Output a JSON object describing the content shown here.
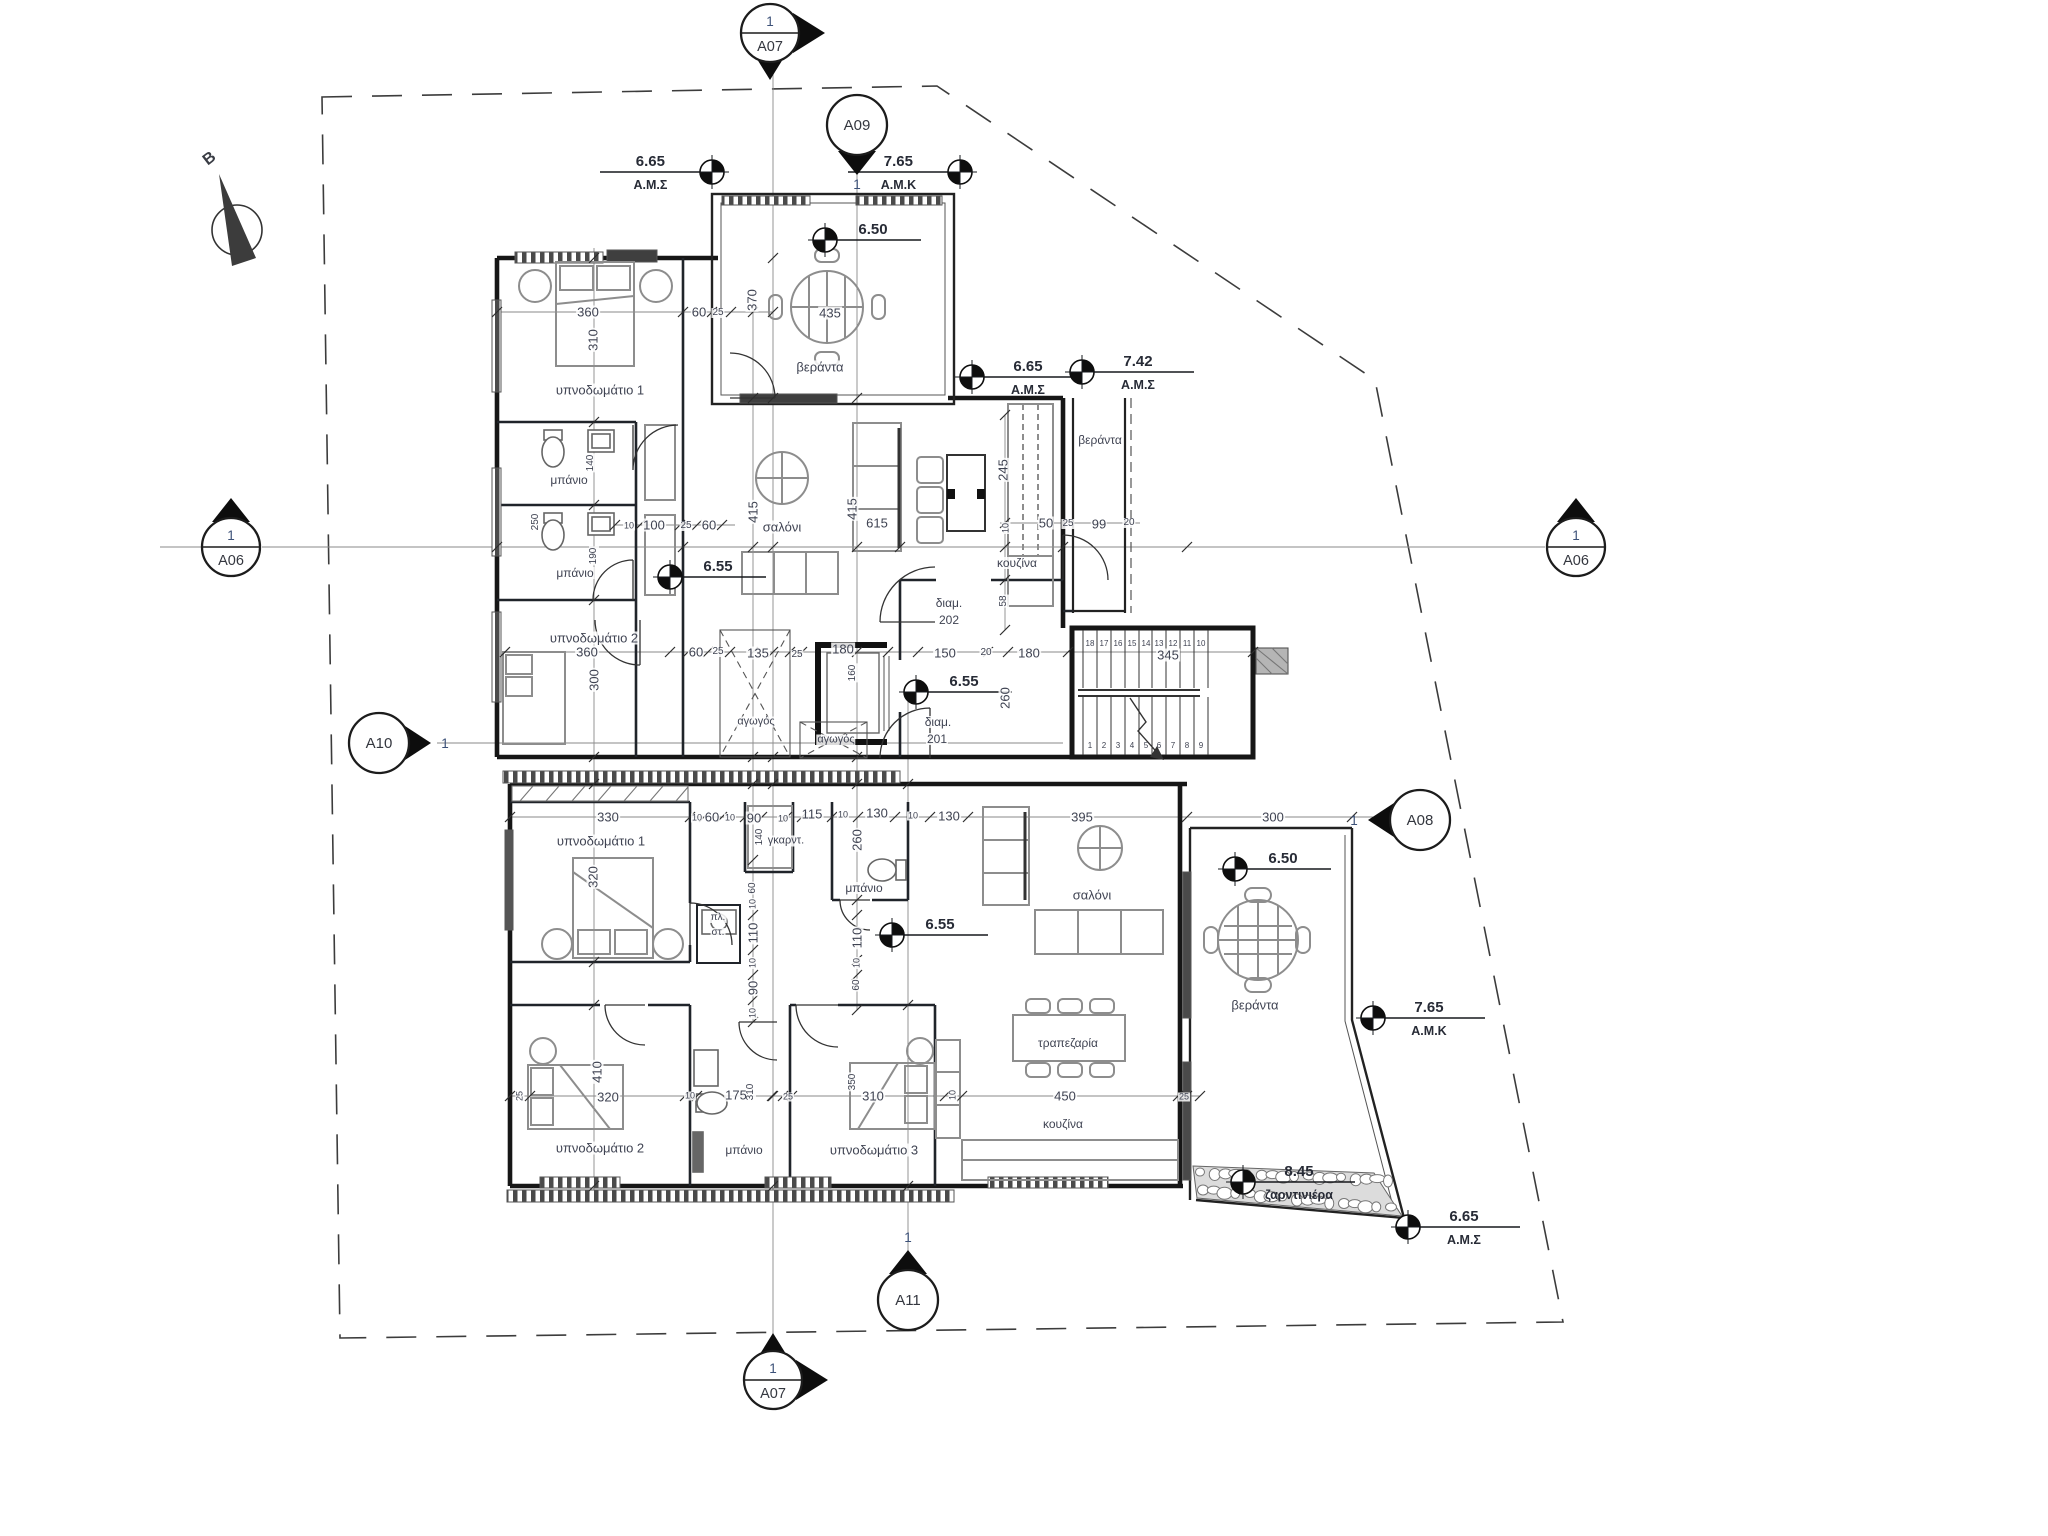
{
  "colors": {
    "wall": "#161616",
    "text": "#3f4352",
    "marker_number_blue": "#3c5178",
    "level_text": "#272b36",
    "boundary": "#3c3c3c"
  },
  "plan": {
    "north_label": "B",
    "sections": [
      {
        "name": "section-marker-a07-top",
        "id": "A07",
        "num": "1",
        "x": 770,
        "y": 33,
        "style": "split",
        "pointer": "right-down"
      },
      {
        "name": "section-marker-a09",
        "id": "A09",
        "num": "1",
        "x": 857,
        "y": 125,
        "style": "plain",
        "pointer": "down"
      },
      {
        "name": "section-marker-a06-left",
        "id": "A06",
        "num": "1",
        "x": 231,
        "y": 547,
        "style": "split",
        "pointer": "up"
      },
      {
        "name": "section-marker-a06-right",
        "id": "A06",
        "num": "1",
        "x": 1576,
        "y": 547,
        "style": "split",
        "pointer": "up"
      },
      {
        "name": "section-marker-a10",
        "id": "A10",
        "num": "1",
        "x": 379,
        "y": 743,
        "style": "plain",
        "pointer": "right"
      },
      {
        "name": "section-marker-a08",
        "id": "A08",
        "num": "1",
        "x": 1420,
        "y": 820,
        "style": "plain",
        "pointer": "left"
      },
      {
        "name": "section-marker-a11",
        "id": "A11",
        "num": "1",
        "x": 908,
        "y": 1300,
        "style": "plain",
        "pointer": "up"
      },
      {
        "name": "section-marker-a07-bottom",
        "id": "A07",
        "num": "1",
        "x": 773,
        "y": 1380,
        "style": "split",
        "pointer": "right-up"
      }
    ],
    "levels": [
      {
        "name": "level-665-top",
        "value": "6.65",
        "sub": "Α.Μ.Σ",
        "x": 712,
        "y": 172,
        "dir": "left"
      },
      {
        "name": "level-765-top",
        "value": "7.65",
        "sub": "Α.Μ.Κ",
        "x": 960,
        "y": 172,
        "dir": "left"
      },
      {
        "name": "level-650-top-veranda",
        "value": "6.50",
        "sub": "",
        "x": 825,
        "y": 240,
        "dir": "right"
      },
      {
        "name": "level-665-mid",
        "value": "6.65",
        "sub": "Α.Μ.Σ",
        "x": 972,
        "y": 377,
        "dir": "right"
      },
      {
        "name": "level-742",
        "value": "7.42",
        "sub": "Α.Μ.Σ",
        "x": 1082,
        "y": 372,
        "dir": "right"
      },
      {
        "name": "level-655-bath",
        "value": "6.55",
        "sub": "",
        "x": 670,
        "y": 577,
        "dir": "right"
      },
      {
        "name": "level-655-hall",
        "value": "6.55",
        "sub": "",
        "x": 916,
        "y": 692,
        "dir": "right"
      },
      {
        "name": "level-655-lower",
        "value": "6.55",
        "sub": "",
        "x": 892,
        "y": 935,
        "dir": "right"
      },
      {
        "name": "level-650-lower-veranda",
        "value": "6.50",
        "sub": "",
        "x": 1235,
        "y": 869,
        "dir": "right"
      },
      {
        "name": "level-765-lower",
        "value": "7.65",
        "sub": "Α.Μ.Κ",
        "x": 1373,
        "y": 1018,
        "dir": "right"
      },
      {
        "name": "level-845-planter",
        "value": "8.45",
        "sub": "ζαρντινιέρα",
        "x": 1243,
        "y": 1182,
        "dir": "right"
      },
      {
        "name": "level-665-bottom",
        "value": "6.65",
        "sub": "Α.Μ.Σ",
        "x": 1408,
        "y": 1227,
        "dir": "right"
      }
    ],
    "rooms": [
      {
        "name": "room-bedroom1-upper",
        "text": "υπνοδωμάτιο 1",
        "x": 600,
        "y": 390,
        "size": 13
      },
      {
        "name": "room-bath1-upper",
        "text": "μπάνιο",
        "x": 569,
        "y": 480,
        "size": 12
      },
      {
        "name": "room-bath2-upper",
        "text": "μπάνιο",
        "x": 575,
        "y": 573,
        "size": 12
      },
      {
        "name": "room-bedroom2-upper",
        "text": "υπνοδωμάτιο 2",
        "x": 594,
        "y": 638,
        "size": 13
      },
      {
        "name": "room-living-upper",
        "text": "σαλόνι",
        "x": 782,
        "y": 527,
        "size": 13
      },
      {
        "name": "room-veranda-top",
        "text": "βεράντα",
        "x": 820,
        "y": 367,
        "size": 13
      },
      {
        "name": "room-veranda-upper-right",
        "text": "βεράντα",
        "x": 1100,
        "y": 440,
        "size": 12
      },
      {
        "name": "room-kitchen-upper",
        "text": "κουζίνα",
        "x": 1017,
        "y": 563,
        "size": 12
      },
      {
        "name": "apt-202-line1",
        "text": "διαμ.",
        "x": 949,
        "y": 603,
        "size": 12
      },
      {
        "name": "apt-202-line2",
        "text": "202",
        "x": 949,
        "y": 620,
        "size": 12
      },
      {
        "name": "apt-201-line1",
        "text": "διαμ.",
        "x": 938,
        "y": 722,
        "size": 12
      },
      {
        "name": "apt-201-line2",
        "text": "201",
        "x": 937,
        "y": 739,
        "size": 12
      },
      {
        "name": "duct-label-1",
        "text": "αγωγός",
        "x": 756,
        "y": 722,
        "size": 11
      },
      {
        "name": "duct-label-2",
        "text": "αγωγός",
        "x": 836,
        "y": 740,
        "size": 11
      },
      {
        "name": "room-bedroom1-lower",
        "text": "υπνοδωμάτιο 1",
        "x": 601,
        "y": 841,
        "size": 13
      },
      {
        "name": "room-wardrobe",
        "text": "γκαρντ.",
        "x": 786,
        "y": 841,
        "size": 11
      },
      {
        "name": "closet-line1",
        "text": "πλ.",
        "x": 718,
        "y": 918,
        "size": 10
      },
      {
        "name": "closet-line2",
        "text": "στ.",
        "x": 718,
        "y": 933,
        "size": 10
      },
      {
        "name": "room-bath-lower",
        "text": "μπάνιο",
        "x": 864,
        "y": 888,
        "size": 12
      },
      {
        "name": "room-living-lower",
        "text": "σαλόνι",
        "x": 1092,
        "y": 895,
        "size": 13
      },
      {
        "name": "room-dining",
        "text": "τραπεζαρία",
        "x": 1068,
        "y": 1043,
        "size": 12
      },
      {
        "name": "room-kitchen-lower",
        "text": "κουζίνα",
        "x": 1063,
        "y": 1124,
        "size": 12
      },
      {
        "name": "room-veranda-lower",
        "text": "βεράντα",
        "x": 1255,
        "y": 1005,
        "size": 13
      },
      {
        "name": "room-bedroom2-bottom",
        "text": "υπνοδωμάτιο 2",
        "x": 600,
        "y": 1148,
        "size": 13
      },
      {
        "name": "room-bath-bottom",
        "text": "μπάνιο",
        "x": 744,
        "y": 1150,
        "size": 12
      },
      {
        "name": "room-bedroom3-bottom",
        "text": "υπνοδωμάτιο 3",
        "x": 874,
        "y": 1150,
        "size": 13
      }
    ],
    "dims": [
      {
        "name": "dim-360-br1",
        "text": "360",
        "x": 588,
        "y": 312
      },
      {
        "name": "dim-310-br1",
        "text": "310",
        "x": 593,
        "y": 340,
        "rot": -90
      },
      {
        "name": "dim-60-a",
        "text": "60",
        "x": 699,
        "y": 312
      },
      {
        "name": "dim-25-a",
        "text": "25",
        "x": 718,
        "y": 313,
        "size": 10
      },
      {
        "name": "dim-370-ver",
        "text": "370",
        "x": 752,
        "y": 300,
        "rot": -90
      },
      {
        "name": "dim-435-ver",
        "text": "435",
        "x": 830,
        "y": 313
      },
      {
        "name": "dim-140-bath",
        "text": "140",
        "x": 591,
        "y": 463,
        "rot": -90,
        "size": 10
      },
      {
        "name": "dim-250-wc",
        "text": "250",
        "x": 536,
        "y": 522,
        "rot": -90,
        "size": 10
      },
      {
        "name": "dim-190-bath2",
        "text": "190",
        "x": 594,
        "y": 556,
        "rot": -90,
        "size": 10
      },
      {
        "name": "dim-10-b",
        "text": "10",
        "x": 629,
        "y": 526,
        "size": 9
      },
      {
        "name": "dim-100-hall",
        "text": "100",
        "x": 654,
        "y": 525
      },
      {
        "name": "dim-25-b",
        "text": "25",
        "x": 686,
        "y": 526,
        "size": 10
      },
      {
        "name": "dim-60-b",
        "text": "60",
        "x": 709,
        "y": 525
      },
      {
        "name": "dim-415-sofa",
        "text": "415",
        "x": 753,
        "y": 512,
        "rot": -90
      },
      {
        "name": "dim-415-c",
        "text": "415",
        "x": 852,
        "y": 509,
        "rot": -90
      },
      {
        "name": "dim-615",
        "text": "615",
        "x": 877,
        "y": 523
      },
      {
        "name": "dim-245",
        "text": "245",
        "x": 1003,
        "y": 470,
        "rot": -90
      },
      {
        "name": "dim-10-c",
        "text": "10",
        "x": 1006,
        "y": 528,
        "rot": -90,
        "size": 9
      },
      {
        "name": "dim-50",
        "text": "50",
        "x": 1046,
        "y": 523
      },
      {
        "name": "dim-25-c",
        "text": "25",
        "x": 1068,
        "y": 524,
        "size": 10
      },
      {
        "name": "dim-99",
        "text": "99",
        "x": 1099,
        "y": 524
      },
      {
        "name": "dim-20-a",
        "text": "20",
        "x": 1129,
        "y": 523,
        "size": 10
      },
      {
        "name": "dim-58",
        "text": "58",
        "x": 1004,
        "y": 601,
        "rot": -90,
        "size": 10
      },
      {
        "name": "dim-360-br2",
        "text": "360",
        "x": 587,
        "y": 652
      },
      {
        "name": "dim-300-br2",
        "text": "300",
        "x": 594,
        "y": 680,
        "rot": -90
      },
      {
        "name": "dim-60-c",
        "text": "60",
        "x": 696,
        "y": 652
      },
      {
        "name": "dim-25-d",
        "text": "25",
        "x": 718,
        "y": 652,
        "size": 10
      },
      {
        "name": "dim-135",
        "text": "135",
        "x": 758,
        "y": 653
      },
      {
        "name": "dim-25-e",
        "text": "25",
        "x": 797,
        "y": 655,
        "size": 10
      },
      {
        "name": "dim-180-lift",
        "text": "180",
        "x": 843,
        "y": 649
      },
      {
        "name": "dim-160-lift",
        "text": "160",
        "x": 853,
        "y": 673,
        "rot": -90,
        "size": 10
      },
      {
        "name": "dim-150",
        "text": "150",
        "x": 945,
        "y": 653
      },
      {
        "name": "dim-20-b",
        "text": "20",
        "x": 986,
        "y": 653,
        "size": 10
      },
      {
        "name": "dim-180-b",
        "text": "180",
        "x": 1029,
        "y": 653
      },
      {
        "name": "dim-345-stairs",
        "text": "345",
        "x": 1168,
        "y": 655
      },
      {
        "name": "dim-260-hall",
        "text": "260",
        "x": 1005,
        "y": 698,
        "rot": -90
      },
      {
        "name": "dim-330",
        "text": "330",
        "x": 608,
        "y": 817
      },
      {
        "name": "dim-10-d",
        "text": "10",
        "x": 697,
        "y": 818,
        "size": 9
      },
      {
        "name": "dim-60-d",
        "text": "60",
        "x": 712,
        "y": 817
      },
      {
        "name": "dim-10-e",
        "text": "10",
        "x": 730,
        "y": 818,
        "size": 9
      },
      {
        "name": "dim-90-a",
        "text": "90",
        "x": 754,
        "y": 818
      },
      {
        "name": "dim-10-f",
        "text": "10",
        "x": 783,
        "y": 819,
        "size": 9
      },
      {
        "name": "dim-140-b",
        "text": "140",
        "x": 760,
        "y": 837,
        "rot": -90,
        "size": 10
      },
      {
        "name": "dim-115",
        "text": "115",
        "x": 812,
        "y": 814
      },
      {
        "name": "dim-10-g",
        "text": "10",
        "x": 843,
        "y": 815,
        "size": 9
      },
      {
        "name": "dim-130-a",
        "text": "130",
        "x": 877,
        "y": 813
      },
      {
        "name": "dim-10-h",
        "text": "10",
        "x": 913,
        "y": 816,
        "size": 9
      },
      {
        "name": "dim-130-b",
        "text": "130",
        "x": 949,
        "y": 816
      },
      {
        "name": "dim-395",
        "text": "395",
        "x": 1082,
        "y": 817
      },
      {
        "name": "dim-300-ver",
        "text": "300",
        "x": 1273,
        "y": 817
      },
      {
        "name": "dim-320-bed",
        "text": "320",
        "x": 593,
        "y": 877,
        "rot": -90
      },
      {
        "name": "dim-260-b",
        "text": "260",
        "x": 857,
        "y": 840,
        "rot": -90
      },
      {
        "name": "dim-60-e",
        "text": "60",
        "x": 753,
        "y": 888,
        "rot": -90,
        "size": 10
      },
      {
        "name": "dim-10-i",
        "text": "10",
        "x": 753,
        "y": 904,
        "rot": -90,
        "size": 9
      },
      {
        "name": "dim-110-a",
        "text": "110",
        "x": 753,
        "y": 933,
        "rot": -90
      },
      {
        "name": "dim-10-j",
        "text": "10",
        "x": 753,
        "y": 963,
        "rot": -90,
        "size": 9
      },
      {
        "name": "dim-90-b",
        "text": "90",
        "x": 753,
        "y": 988,
        "rot": -90
      },
      {
        "name": "dim-10-k",
        "text": "10",
        "x": 753,
        "y": 1013,
        "rot": -90,
        "size": 9
      },
      {
        "name": "dim-110-b",
        "text": "110",
        "x": 857,
        "y": 938,
        "rot": -90
      },
      {
        "name": "dim-10-l",
        "text": "10",
        "x": 857,
        "y": 963,
        "rot": -90,
        "size": 9
      },
      {
        "name": "dim-60-f",
        "text": "60",
        "x": 857,
        "y": 985,
        "rot": -90,
        "size": 10
      },
      {
        "name": "dim-410",
        "text": "410",
        "x": 597,
        "y": 1072,
        "rot": -90
      },
      {
        "name": "dim-320-b",
        "text": "320",
        "x": 608,
        "y": 1097
      },
      {
        "name": "dim-25-f",
        "text": "25",
        "x": 520,
        "y": 1096,
        "rot": -90,
        "size": 9
      },
      {
        "name": "dim-10-m",
        "text": "10",
        "x": 690,
        "y": 1096,
        "size": 9
      },
      {
        "name": "dim-175",
        "text": "175",
        "x": 736,
        "y": 1095
      },
      {
        "name": "dim-310-v",
        "text": "310",
        "x": 751,
        "y": 1092,
        "rot": -90,
        "size": 10
      },
      {
        "name": "dim-25-g",
        "text": "25",
        "x": 788,
        "y": 1097,
        "size": 9
      },
      {
        "name": "dim-350",
        "text": "350",
        "x": 853,
        "y": 1082,
        "rot": -90,
        "size": 10
      },
      {
        "name": "dim-310-b",
        "text": "310",
        "x": 873,
        "y": 1096
      },
      {
        "name": "dim-10-n",
        "text": "10",
        "x": 953,
        "y": 1095,
        "rot": -90,
        "size": 9
      },
      {
        "name": "dim-450",
        "text": "450",
        "x": 1065,
        "y": 1096
      },
      {
        "name": "dim-25-h",
        "text": "25",
        "x": 1184,
        "y": 1097,
        "size": 9
      }
    ],
    "stair_upper": [
      "18",
      "17",
      "16",
      "15",
      "14",
      "13",
      "12",
      "11",
      "10"
    ],
    "stair_lower": [
      "1",
      "2",
      "3",
      "4",
      "5",
      "6",
      "7",
      "8",
      "9"
    ]
  }
}
